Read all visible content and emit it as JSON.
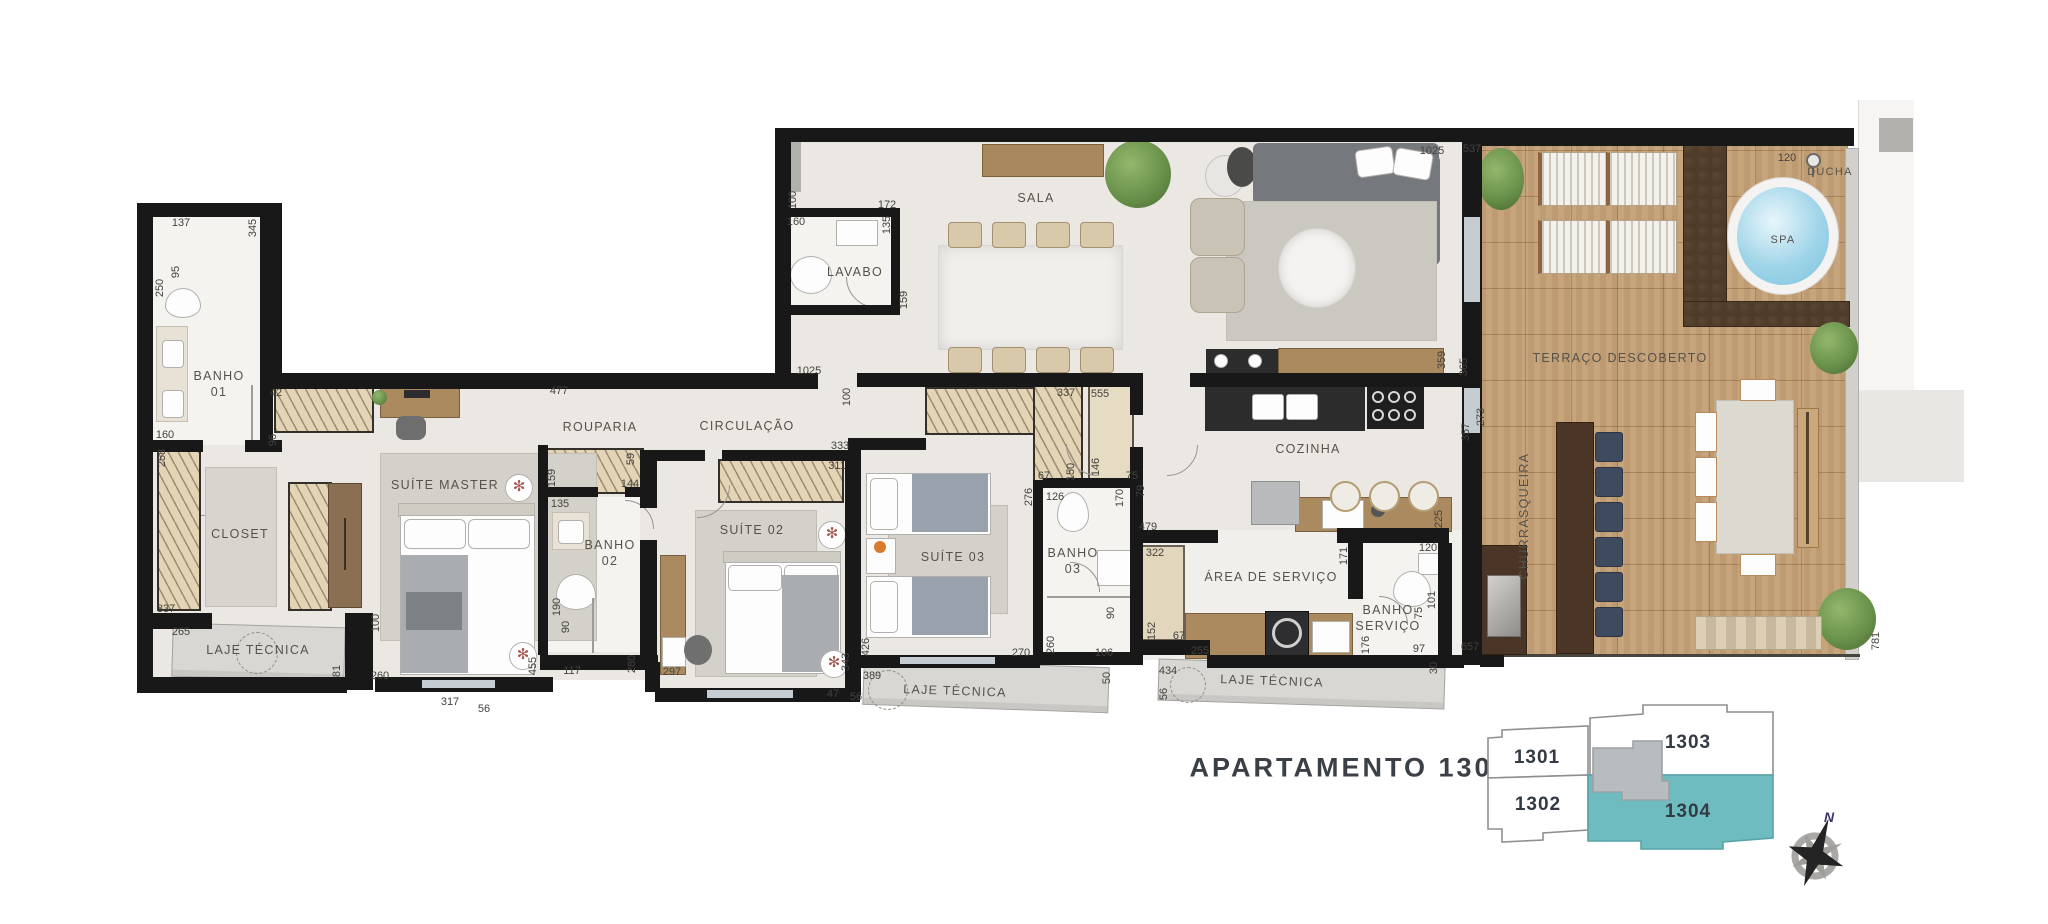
{
  "title": "APARTAMENTO 1304",
  "colors": {
    "wall": "#181818",
    "floor": "#ebe8e3",
    "bath_floor": "#f4f3f0",
    "laje": "#d9d7d3",
    "deck_wood": "#c7a57c",
    "planter_soil": "#4f3b27",
    "highlight_unit_teal": "#6fbcc0",
    "keyplan_core_gray": "#b9bcbe",
    "spa_water": "#9fd4e8",
    "dimension_text": "#44423e",
    "label_text": "#55524c",
    "title_text": "#3a4046",
    "compass_north": "#3b3473"
  },
  "icons": {
    "fan_glyph": "✻"
  },
  "compass": {
    "north_label": "N"
  },
  "keyplan": {
    "highlighted": "1304",
    "units": [
      {
        "id": "1301",
        "label": "1301"
      },
      {
        "id": "1302",
        "label": "1302"
      },
      {
        "id": "1303",
        "label": "1303"
      },
      {
        "id": "1304",
        "label": "1304"
      }
    ]
  },
  "plan": {
    "rooms": [
      {
        "id": "banho-01",
        "label": "BANHO\n01",
        "x": 219,
        "y": 384
      },
      {
        "id": "closet",
        "label": "CLOSET",
        "x": 240,
        "y": 534
      },
      {
        "id": "laje-tecnica-1",
        "label": "LAJE TÉCNICA",
        "x": 258,
        "y": 650
      },
      {
        "id": "suite-master",
        "label": "SUÍTE MASTER",
        "x": 445,
        "y": 485
      },
      {
        "id": "rouparia",
        "label": "ROUPARIA",
        "x": 600,
        "y": 427
      },
      {
        "id": "circulacao",
        "label": "CIRCULAÇÃO",
        "x": 747,
        "y": 426
      },
      {
        "id": "banho-02",
        "label": "BANHO\n02",
        "x": 610,
        "y": 553
      },
      {
        "id": "suite-02",
        "label": "SUÍTE 02",
        "x": 752,
        "y": 530
      },
      {
        "id": "suite-03",
        "label": "SUÍTE 03",
        "x": 953,
        "y": 557
      },
      {
        "id": "banho-03",
        "label": "BANHO\n03",
        "x": 1073,
        "y": 561
      },
      {
        "id": "lavabo",
        "label": "LAVABO",
        "x": 855,
        "y": 272
      },
      {
        "id": "sala",
        "label": "SALA",
        "x": 1036,
        "y": 198
      },
      {
        "id": "cozinha",
        "label": "COZINHA",
        "x": 1308,
        "y": 449
      },
      {
        "id": "area-de-servico",
        "label": "ÁREA DE SERVIÇO",
        "x": 1271,
        "y": 577
      },
      {
        "id": "banho-servico",
        "label": "BANHO\nSERVIÇO",
        "x": 1388,
        "y": 618
      },
      {
        "id": "laje-tecnica-2",
        "label": "LAJE TÉCNICA",
        "x": 955,
        "y": 691,
        "tilt": true
      },
      {
        "id": "laje-tecnica-3",
        "label": "LAJE TÉCNICA",
        "x": 1272,
        "y": 681,
        "tilt": true
      },
      {
        "id": "terraco-descoberto",
        "label": "TERRAÇO DESCOBERTO",
        "x": 1620,
        "y": 358
      },
      {
        "id": "churrasqueira",
        "label": "CHURRASQUEIRA",
        "x": 1524,
        "y": 516,
        "vert": true
      },
      {
        "id": "spa",
        "label": "SPA",
        "x": 1783,
        "y": 240,
        "size": 11
      },
      {
        "id": "ducha",
        "label": "DUCHA",
        "x": 1830,
        "y": 172,
        "size": 11
      }
    ],
    "dimensions": [
      {
        "label": "137",
        "x": 181,
        "y": 223
      },
      {
        "label": "345",
        "x": 253,
        "y": 228,
        "v": true
      },
      {
        "label": "95",
        "x": 176,
        "y": 272,
        "v": true
      },
      {
        "label": "250",
        "x": 160,
        "y": 288,
        "v": true
      },
      {
        "label": "160",
        "x": 165,
        "y": 435
      },
      {
        "label": "258",
        "x": 162,
        "y": 458,
        "v": true
      },
      {
        "label": "42",
        "x": 276,
        "y": 393
      },
      {
        "label": "96",
        "x": 273,
        "y": 440,
        "v": true
      },
      {
        "label": "477",
        "x": 559,
        "y": 391
      },
      {
        "label": "337",
        "x": 166,
        "y": 609
      },
      {
        "label": "265",
        "x": 181,
        "y": 632
      },
      {
        "label": "81",
        "x": 337,
        "y": 671,
        "v": true
      },
      {
        "label": "100",
        "x": 376,
        "y": 623,
        "v": true
      },
      {
        "label": "260",
        "x": 380,
        "y": 676
      },
      {
        "label": "455",
        "x": 533,
        "y": 666,
        "v": true
      },
      {
        "label": "317",
        "x": 450,
        "y": 702
      },
      {
        "label": "56",
        "x": 484,
        "y": 709
      },
      {
        "label": "159",
        "x": 552,
        "y": 478,
        "v": true
      },
      {
        "label": "59",
        "x": 631,
        "y": 459,
        "v": true
      },
      {
        "label": "144",
        "x": 630,
        "y": 484
      },
      {
        "label": "135",
        "x": 560,
        "y": 504
      },
      {
        "label": "190",
        "x": 557,
        "y": 607,
        "v": true
      },
      {
        "label": "90",
        "x": 566,
        "y": 627,
        "v": true
      },
      {
        "label": "117",
        "x": 572,
        "y": 671
      },
      {
        "label": "280",
        "x": 632,
        "y": 664,
        "v": true
      },
      {
        "label": "297",
        "x": 672,
        "y": 672
      },
      {
        "label": "343",
        "x": 846,
        "y": 662,
        "v": true
      },
      {
        "label": "333",
        "x": 840,
        "y": 446
      },
      {
        "label": "311",
        "x": 837,
        "y": 466
      },
      {
        "label": "1025",
        "x": 809,
        "y": 371
      },
      {
        "label": "100",
        "x": 847,
        "y": 397,
        "v": true
      },
      {
        "label": "100",
        "x": 793,
        "y": 200,
        "v": true
      },
      {
        "label": "172",
        "x": 887,
        "y": 205
      },
      {
        "label": "160",
        "x": 796,
        "y": 222
      },
      {
        "label": "135",
        "x": 887,
        "y": 225,
        "v": true
      },
      {
        "label": "159",
        "x": 904,
        "y": 300,
        "v": true
      },
      {
        "label": "1025",
        "x": 1432,
        "y": 151
      },
      {
        "label": "537",
        "x": 1472,
        "y": 149
      },
      {
        "label": "337",
        "x": 1066,
        "y": 393
      },
      {
        "label": "67",
        "x": 1044,
        "y": 476
      },
      {
        "label": "150",
        "x": 1071,
        "y": 472,
        "v": true
      },
      {
        "label": "555",
        "x": 1100,
        "y": 394
      },
      {
        "label": "146",
        "x": 1096,
        "y": 467,
        "v": true
      },
      {
        "label": "75",
        "x": 1132,
        "y": 476
      },
      {
        "label": "276",
        "x": 1029,
        "y": 497,
        "v": true
      },
      {
        "label": "126",
        "x": 1055,
        "y": 497
      },
      {
        "label": "170",
        "x": 1120,
        "y": 498,
        "v": true
      },
      {
        "label": "90",
        "x": 1111,
        "y": 613,
        "v": true
      },
      {
        "label": "260",
        "x": 1051,
        "y": 645,
        "v": true
      },
      {
        "label": "106",
        "x": 1104,
        "y": 653
      },
      {
        "label": "270",
        "x": 1021,
        "y": 653
      },
      {
        "label": "426",
        "x": 866,
        "y": 647,
        "v": true
      },
      {
        "label": "389",
        "x": 872,
        "y": 676
      },
      {
        "label": "47",
        "x": 833,
        "y": 694
      },
      {
        "label": "56",
        "x": 856,
        "y": 697
      },
      {
        "label": "50",
        "x": 1107,
        "y": 678,
        "v": true
      },
      {
        "label": "359",
        "x": 1442,
        "y": 360,
        "v": true
      },
      {
        "label": "365",
        "x": 1464,
        "y": 367,
        "v": true
      },
      {
        "label": "273",
        "x": 1481,
        "y": 417,
        "v": true
      },
      {
        "label": "357",
        "x": 1466,
        "y": 432,
        "v": true
      },
      {
        "label": "79",
        "x": 1141,
        "y": 491,
        "v": true
      },
      {
        "label": "479",
        "x": 1148,
        "y": 527
      },
      {
        "label": "322",
        "x": 1155,
        "y": 553
      },
      {
        "label": "152",
        "x": 1152,
        "y": 631,
        "v": true
      },
      {
        "label": "67",
        "x": 1179,
        "y": 636
      },
      {
        "label": "255",
        "x": 1200,
        "y": 651
      },
      {
        "label": "225",
        "x": 1439,
        "y": 519,
        "v": true
      },
      {
        "label": "171",
        "x": 1344,
        "y": 556,
        "v": true
      },
      {
        "label": "120",
        "x": 1428,
        "y": 548
      },
      {
        "label": "101",
        "x": 1432,
        "y": 600,
        "v": true
      },
      {
        "label": "75",
        "x": 1419,
        "y": 613,
        "v": true
      },
      {
        "label": "176",
        "x": 1366,
        "y": 645,
        "v": true
      },
      {
        "label": "97",
        "x": 1419,
        "y": 649
      },
      {
        "label": "30",
        "x": 1434,
        "y": 668,
        "v": true
      },
      {
        "label": "657",
        "x": 1470,
        "y": 647
      },
      {
        "label": "434",
        "x": 1168,
        "y": 671
      },
      {
        "label": "56",
        "x": 1164,
        "y": 694,
        "v": true
      },
      {
        "label": "120",
        "x": 1787,
        "y": 158
      },
      {
        "label": "781",
        "x": 1876,
        "y": 641,
        "v": true
      }
    ]
  }
}
